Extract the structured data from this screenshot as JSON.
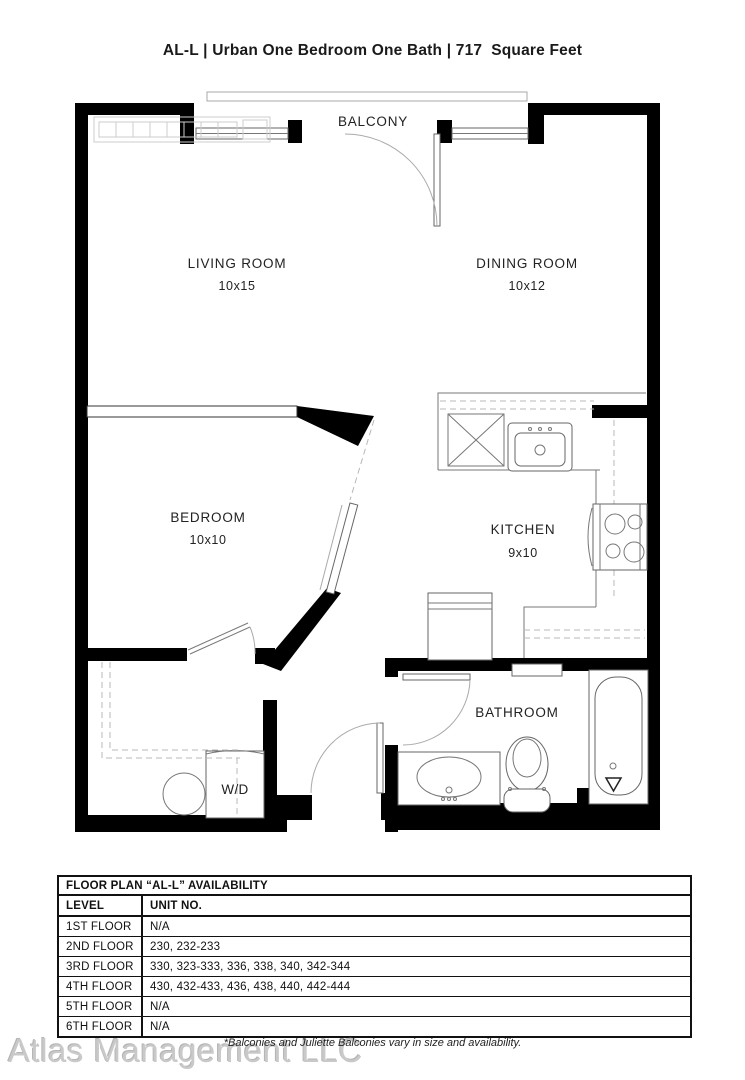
{
  "header": {
    "title": "AL-L | Urban One Bedroom One Bath | 717  Square Feet"
  },
  "floor_plan": {
    "balcony_label": "BALCONY",
    "rooms": {
      "living": {
        "name": "LIVING ROOM",
        "dims": "10x15"
      },
      "dining": {
        "name": "DINING ROOM",
        "dims": "10x12"
      },
      "bedroom": {
        "name": "BEDROOM",
        "dims": "10x10"
      },
      "kitchen": {
        "name": "KITCHEN",
        "dims": "9x10"
      },
      "bathroom": {
        "name": "BATHROOM"
      }
    },
    "fixtures": {
      "washer_dryer_label": "W/D"
    }
  },
  "availability_table": {
    "title": "FLOOR PLAN “AL-L” AVAILABILITY",
    "columns": {
      "level": "LEVEL",
      "unit": "UNIT NO."
    },
    "rows": [
      {
        "level": "1ST FLOOR",
        "units": "N/A"
      },
      {
        "level": "2ND FLOOR",
        "units": "230, 232-233"
      },
      {
        "level": "3RD FLOOR",
        "units": "330, 323-333, 336, 338, 340, 342-344"
      },
      {
        "level": "4TH FLOOR",
        "units": "430, 432-433, 436, 438, 440, 442-444"
      },
      {
        "level": "5TH FLOOR",
        "units": "N/A"
      },
      {
        "level": "6TH FLOOR",
        "units": "N/A"
      }
    ]
  },
  "footer": {
    "disclaimer": "*Balconies and Juliette Balconies vary in size and availability.",
    "watermark": "Atlas Management LLC"
  },
  "colors": {
    "wall": "#000000",
    "thin_line": "#777777",
    "dashed_line": "#b8b8b8",
    "watermark": "#c9c9c9",
    "text": "#111111"
  }
}
